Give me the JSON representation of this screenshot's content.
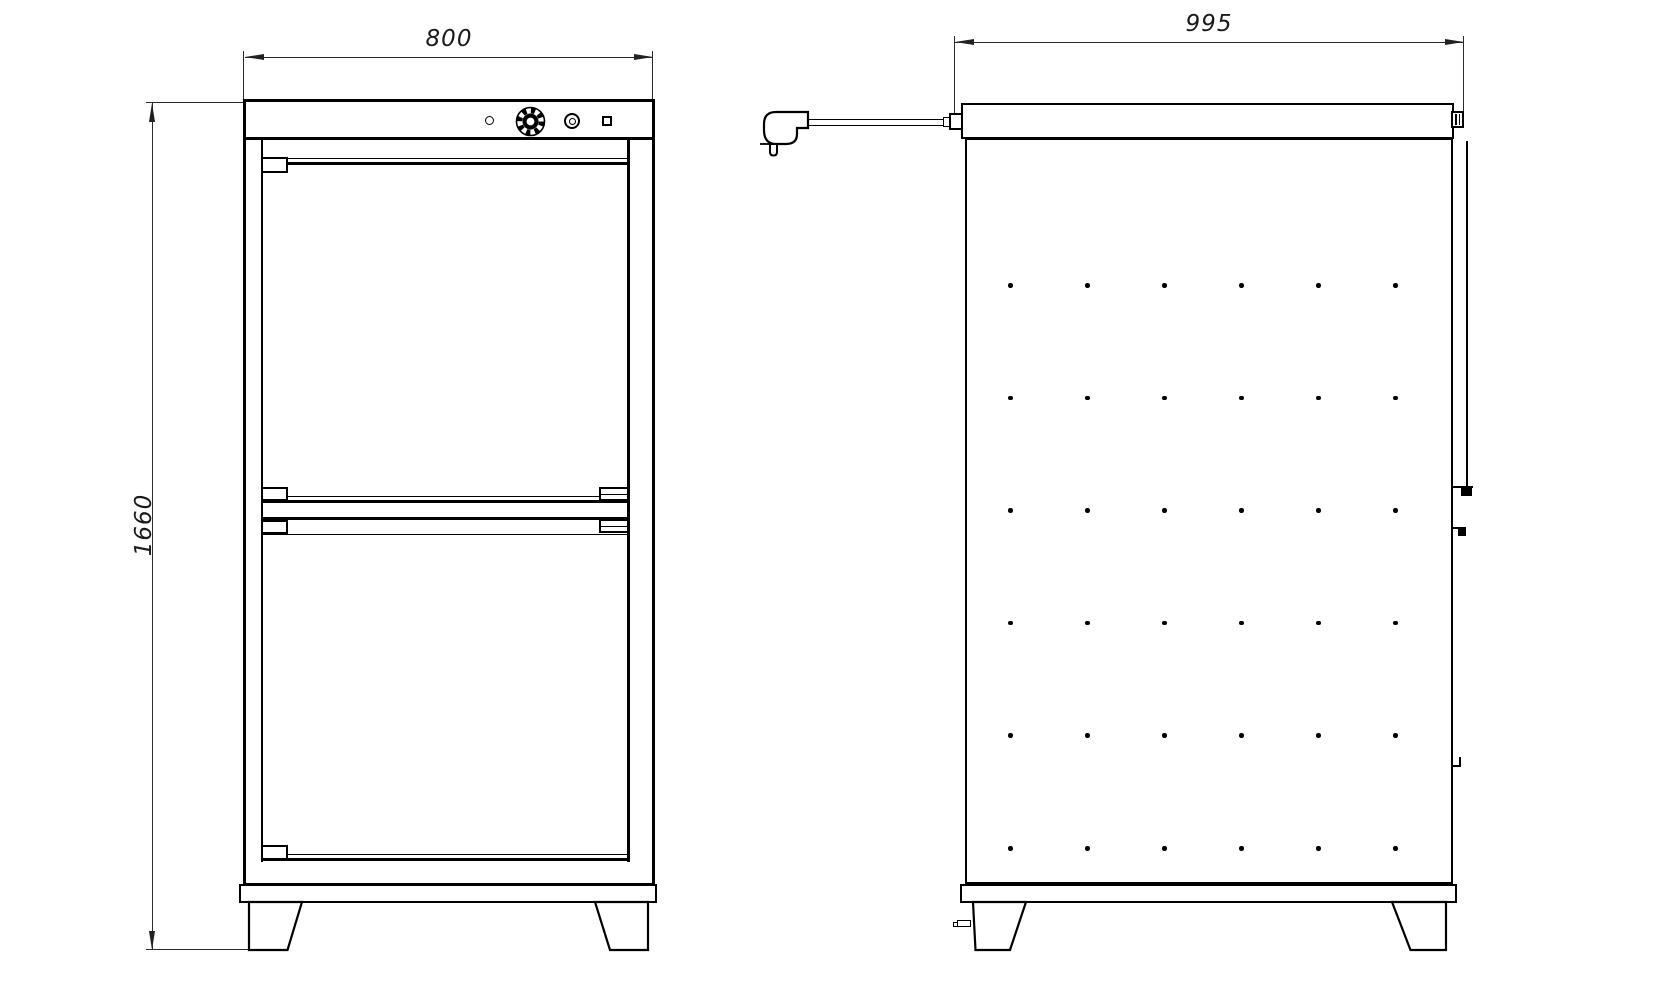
{
  "dimensions": {
    "front_width": "800",
    "overall_height": "1660",
    "side_depth": "995"
  },
  "front_view": {
    "doors": 2,
    "controls": {
      "indicator": "indicator-light",
      "knob": "thermostat-knob",
      "lamp": "pilot-lamp",
      "switch": "power-switch"
    }
  },
  "side_view": {
    "perforation_grid": {
      "rows": 6,
      "cols": 6
    },
    "power_cord": "power-plug"
  },
  "colors": {
    "background": "#ffffff",
    "line": "#000000",
    "dimension": "#222222"
  }
}
